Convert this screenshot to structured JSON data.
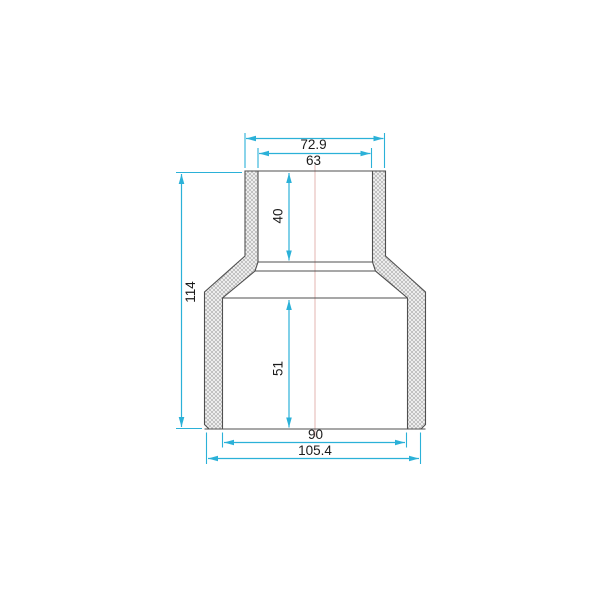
{
  "drawing": {
    "dimensions": {
      "top_outer_width": "72.9",
      "top_inner_width": "63",
      "top_socket_depth": "40",
      "overall_height": "114",
      "bottom_socket_depth": "51",
      "bottom_inner_width": "90",
      "bottom_outer_width": "105.4"
    },
    "colors": {
      "dim": "#2bb1d8",
      "outline": "#4f4f4f",
      "center": "#e3b4b0",
      "hatch_line": "#b0b0b0",
      "hatch_bg": "#f6f6f6",
      "bg": "#ffffff"
    }
  }
}
